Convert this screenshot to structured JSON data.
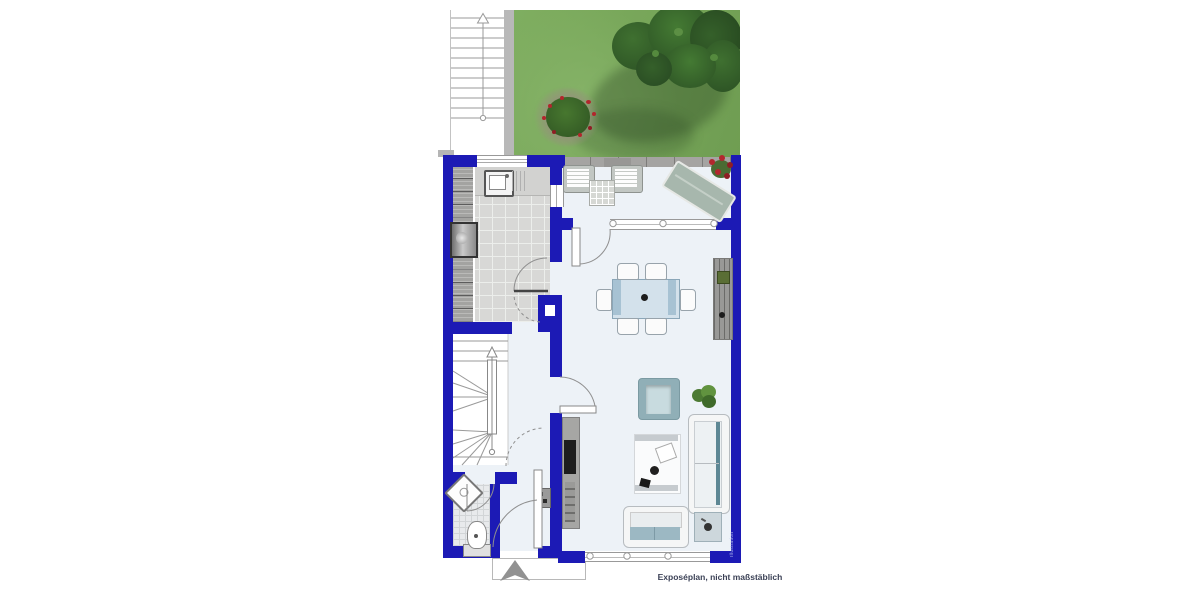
{
  "caption": {
    "text": "Exposéplan, nicht maßstäblich"
  },
  "watermark": {
    "text": "Illustration"
  },
  "colors": {
    "wall_blue": "#1c1ab5",
    "grass_green": "#7aa95c",
    "tree_green": "#2a4f23",
    "terrace_grey": "#a5a4a2",
    "kitchen_tile_grey": "#d8d8d6",
    "interior_floor": "#edf2f7",
    "upholstery_teal": "#9cb8c3",
    "armchair_teal": "#90afb7",
    "flower_red": "#b3272e",
    "caption_text": "#3b4156"
  },
  "icons": {
    "entrance_arrow": "solid up-triangle",
    "exterior_stair_arrow": "up-arrow with start circle",
    "interior_stair_arrow": "up-arrow with start circle"
  }
}
